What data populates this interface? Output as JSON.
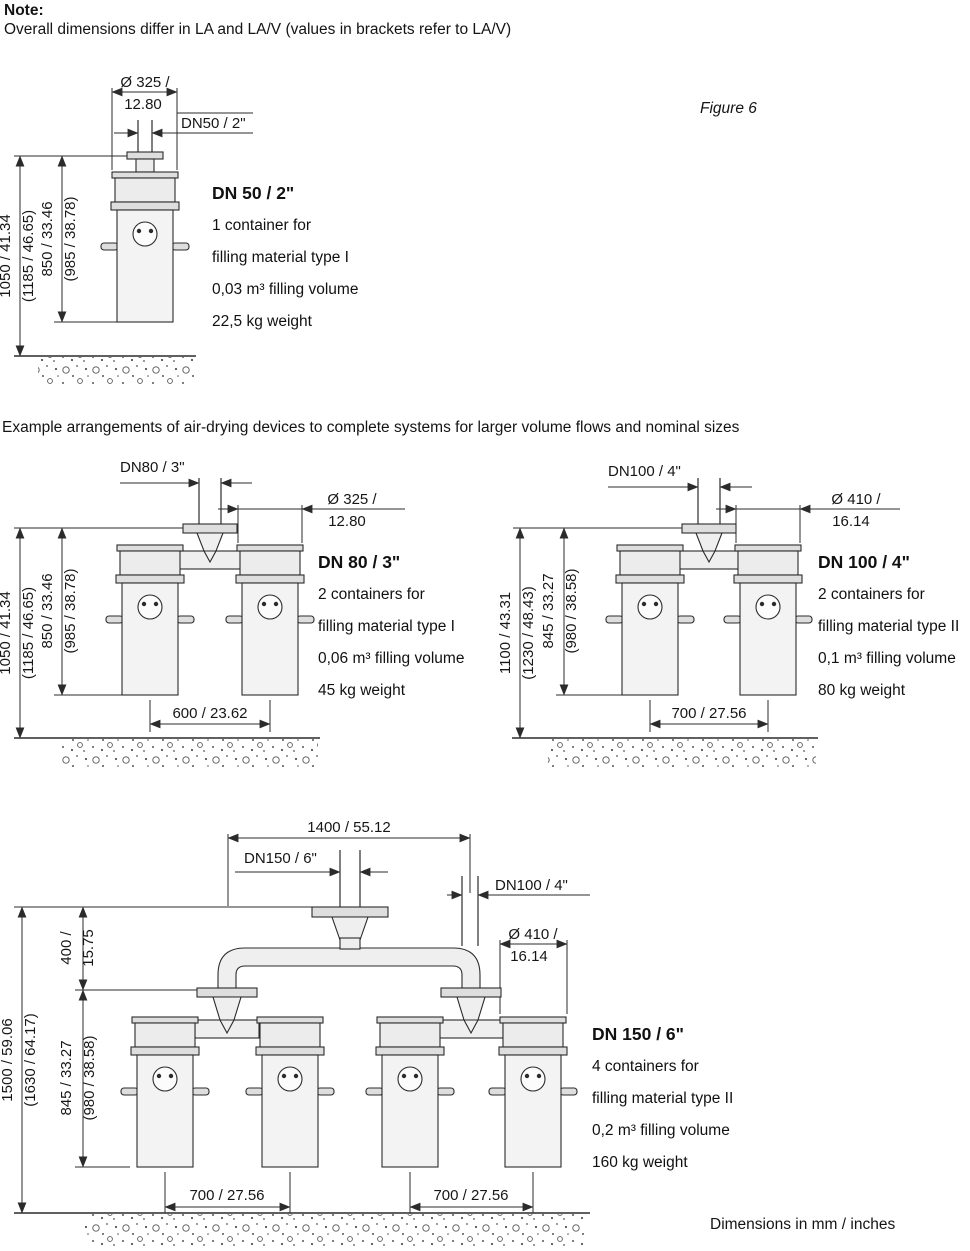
{
  "note": {
    "title": "Note:",
    "body": "Overall dimensions differ in LA and LA/V (values in brackets refer to LA/V)"
  },
  "figure_label": "Figure 6",
  "intro": "Example arrangements of air-drying devices to complete systems for larger volume flows and nominal sizes",
  "footer": "Dimensions in mm / inches",
  "figures": {
    "dn50": {
      "title": "DN 50 / 2\"",
      "specs": [
        "1 container for",
        "filling material type I",
        "0,03 m³ filling volume",
        "22,5 kg weight"
      ],
      "dims": {
        "diameter_line1": "Ø 325 /",
        "diameter_line2": "12.80",
        "nominal": "DN50 / 2\"",
        "total_height": "1050 / 41.34",
        "total_height_alt": "(1185 / 46.65)",
        "body_height": "850 / 33.46",
        "body_height_alt": "(985 / 38.78)"
      }
    },
    "dn80": {
      "title": "DN 80 / 3\"",
      "specs": [
        "2 containers for",
        "filling material type I",
        "0,06 m³ filling volume",
        "45 kg weight"
      ],
      "dims": {
        "nominal": "DN80 / 3\"",
        "diameter_line1": "Ø 325 /",
        "diameter_line2": "12.80",
        "total_height": "1050 / 41.34",
        "total_height_alt": "(1185 / 46.65)",
        "body_height": "850 / 33.46",
        "body_height_alt": "(985 / 38.78)",
        "spacing": "600 / 23.62"
      }
    },
    "dn100": {
      "title": "DN 100 / 4\"",
      "specs": [
        "2 containers for",
        "filling material type II",
        "0,1 m³ filling volume",
        "80 kg weight"
      ],
      "dims": {
        "nominal": "DN100 / 4\"",
        "diameter_line1": "Ø 410 /",
        "diameter_line2": "16.14",
        "total_height": "1100 / 43.31",
        "total_height_alt": "(1230 / 48.43)",
        "body_height": "845 / 33.27",
        "body_height_alt": "(980 / 38.58)",
        "spacing": "700 / 27.56"
      }
    },
    "dn150": {
      "title": "DN 150 / 6\"",
      "specs": [
        "4 containers for",
        "filling material type II",
        "0,2 m³ filling volume",
        "160 kg weight"
      ],
      "dims": {
        "overall_width": "1400 / 55.12",
        "nominal": "DN150 / 6\"",
        "branch": "DN100 / 4\"",
        "diameter_line1": "Ø 410 /",
        "diameter_line2": "16.14",
        "riser_line1": "400 /",
        "riser_line2": "15.75",
        "total_height": "1500 / 59.06",
        "total_height_alt": "(1630 / 64.17)",
        "body_height": "845 / 33.27",
        "body_height_alt": "(980 / 38.58)",
        "spacing_left": "700 / 27.56",
        "spacing_right": "700 / 27.56"
      }
    }
  }
}
